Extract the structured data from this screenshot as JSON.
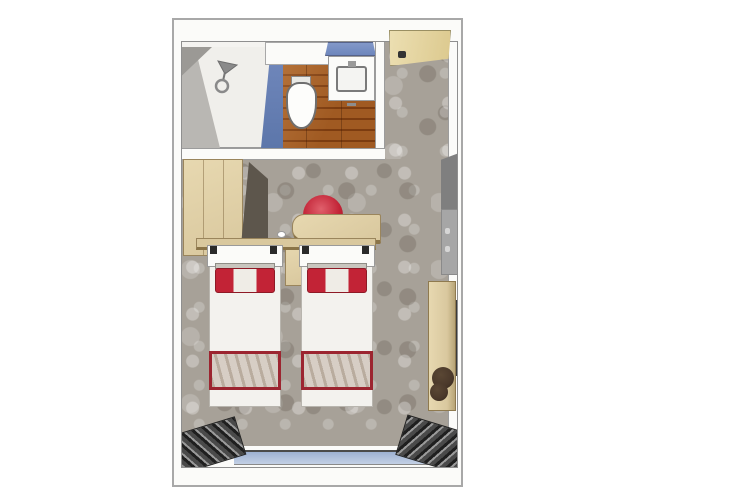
{
  "scene": {
    "type": "floor-plan",
    "description": "top-down 3D rendered floor plan of a twin-bed cabin with en-suite bathroom",
    "rooms": [
      "shower",
      "bathroom",
      "entry",
      "main-cabin"
    ],
    "objects": [
      "shower-head",
      "toilet",
      "sink-vanity",
      "vanity-shelf",
      "entry-door",
      "wardrobe",
      "counter",
      "desk",
      "chair",
      "nightstand",
      "twin-bed-left",
      "twin-bed-right",
      "bed-pillow",
      "bed-runner",
      "wall-panel",
      "wall-mirror",
      "sideboard",
      "stool",
      "window",
      "curtain-left",
      "curtain-right"
    ]
  },
  "palette": {
    "wall": "#fbfbf9",
    "wall-line": "#9a9a9a",
    "carpet": "#a7a198",
    "wood": "#d9c89e",
    "wood-light": "#e7d8b0",
    "wood-edge": "#8a7448",
    "floor1": "#a05a22",
    "floor2": "#7c3c10",
    "blue-wall1": "#7289bd",
    "blue-wall2": "#5c76aa",
    "vanity-blue1": "#8298c9",
    "vanity-blue2": "#6d86bc",
    "window-blue1": "#9db1d2",
    "window-blue2": "#c3d0e5",
    "red": "#c22336",
    "red-dark": "#971425",
    "red-border": "#9c2530",
    "runner": "#d7cec5",
    "curtain-dark": "#1f1f1f",
    "curtain-mid": "#4a4a4a",
    "curtain-light": "#9a9a9a",
    "panel-dark": "#7f7f7f",
    "panel-light": "#a6a6a6",
    "door-beige1": "#ecdfb2",
    "door-beige2": "#dcc98e",
    "stool-brown": "#4a382a",
    "shower-gray": "#b9b7b3",
    "white-soft": "#f3f2ee"
  }
}
